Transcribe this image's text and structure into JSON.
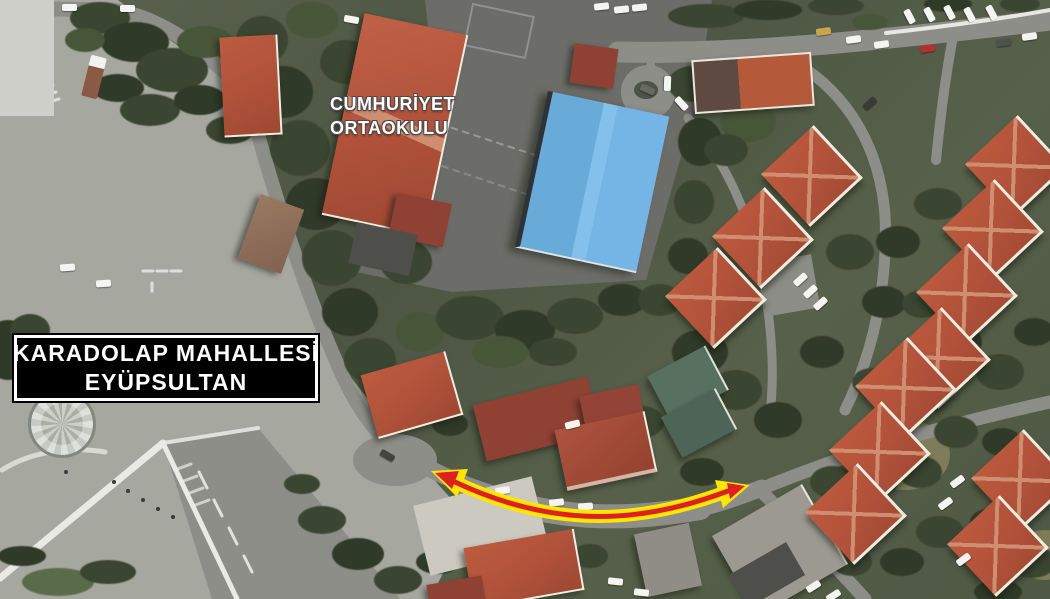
{
  "labels": {
    "school": {
      "line1": "CUMHURİYET",
      "line2": "ORTAOKULU"
    },
    "region": {
      "line1": "KARADOLAP MAHALLESİ",
      "line2": "EYÜPSULTAN"
    }
  },
  "arrow": {
    "description": "double-headed curved route arrow along the road",
    "stroke": "#dd2020",
    "outline": "#ffe600"
  },
  "palette": {
    "pavement": "#a6a79f",
    "road": "#8d8e88",
    "yard": "#6c6c68",
    "roof-red": "#b0513a",
    "roof-dark": "#8f4134",
    "roof-edge": "#f2ece0",
    "gym-blue": "#74b5e6",
    "gray-roof": "#9c9a90",
    "label-bg": "#000000",
    "label-fg": "#ffffff",
    "khaki": "#8d8760"
  }
}
